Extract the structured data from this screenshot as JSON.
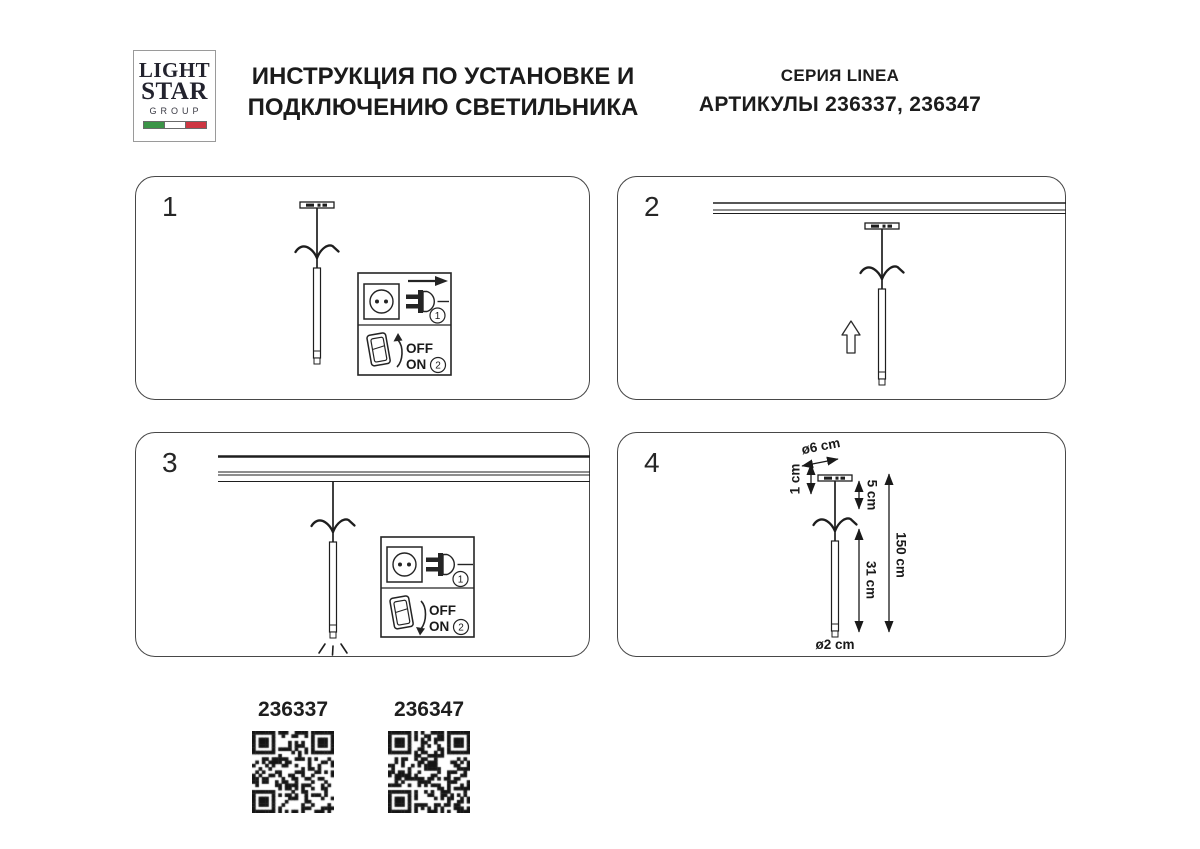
{
  "header": {
    "logo": {
      "line1": "LIGHT",
      "line2": "STAR",
      "line3": "GROUP",
      "flag_colors": [
        "#3b9447",
        "#ffffff",
        "#cd3642"
      ]
    },
    "title_line1": "ИНСТРУКЦИЯ ПО УСТАНОВКЕ И",
    "title_line2": "ПОДКЛЮЧЕНИЮ СВЕТИЛЬНИКА",
    "series": "СЕРИЯ LINEA",
    "articles": "АРТИКУЛЫ 236337, 236347"
  },
  "panels": [
    {
      "number": "1"
    },
    {
      "number": "2"
    },
    {
      "number": "3"
    },
    {
      "number": "4"
    }
  ],
  "inset": {
    "off_label": "OFF",
    "on_label": "ON",
    "step1": "1",
    "step2": "2"
  },
  "dimensions": {
    "canopy_diameter": "ø6 cm",
    "canopy_height": "1 cm",
    "stem_height": "5 cm",
    "tube_height": "31 cm",
    "total_height": "150 cm",
    "tube_diameter": "ø2 cm"
  },
  "qr_codes": [
    {
      "label": "236337"
    },
    {
      "label": "236347"
    }
  ]
}
